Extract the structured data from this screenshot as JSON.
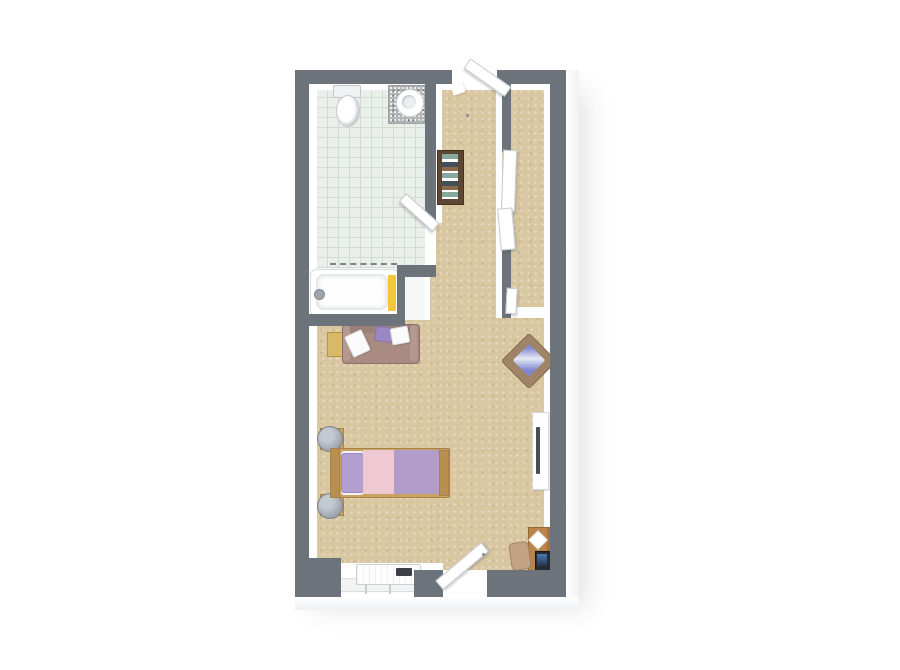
{
  "meta": {
    "type": "3d-floor-plan-top-view",
    "description": "Top-down 3D rendered floor plan of a studio suite: bathroom with tiled floor at top left, entry hall, right-side closet, and a combined living/sleeping room",
    "visible_text": ""
  },
  "colors": {
    "pageBg": "#ffffff",
    "wall": "#6c737b",
    "wallFace": "#ffffff",
    "carpet": "#d9c7a1",
    "tile": "#eaf0e9",
    "tileLine": "#cfdccf",
    "bathFloor": "#f6f7f7",
    "porcelain": "#eff1f3",
    "granite": "#b5b6b8",
    "towel": "#f2c73b",
    "curtain": "#5a5f63",
    "walnut": "#5f4632",
    "books1": "#86a89e",
    "books2": "#ffffff",
    "books3": "#43505a",
    "books4": "#8a6a4a",
    "sofa": "#a98b82",
    "sofaDark": "#8d7168",
    "sofaLight": "#b59890",
    "pillowWhite": "#fafafa",
    "pillowPurple": "#9d87c2",
    "tableWood": "#d8b96a",
    "wood": "#c9a25f",
    "woodDark": "#a8824a",
    "woodEdge": "#b78f4e",
    "pink": "#efc9d2",
    "lavender": "#b19cca",
    "bedPillow": "#b29fd0",
    "stool": "#9fa5ad",
    "stoolRing": "#7d838a",
    "chairWood": "#a08468",
    "cushionBlue": "#8087d2",
    "cushionLight": "#e6e9f5",
    "consoleWhite": "#fdfdfd",
    "tvDark": "#474c52",
    "oak": "#b9854a",
    "oakDark": "#96682f",
    "monitor": "#252b31",
    "screen": "#4a7ab5",
    "deskChair": "#c2a385",
    "ptac": "#fdfdfd",
    "vent": "#3c4147",
    "glass": "#f2f4f4",
    "mullion": "#c9ccce"
  },
  "rooms": {
    "bathroom": {
      "label": "Bathroom with tiled floor, toilet, vanity sink and bathtub"
    },
    "entry": {
      "label": "Entry hall with open door"
    },
    "closet": {
      "label": "Closet with sliding doors"
    },
    "living": {
      "label": "Living and sleeping area with carpet floor"
    }
  },
  "furniture": {
    "toilet": {
      "label": "Toilet"
    },
    "vanity": {
      "label": "Vanity counter with round sink"
    },
    "bathtub": {
      "label": "Bathtub with yellow towel"
    },
    "shower": {
      "label": "Wall-mounted shower head"
    },
    "curtain": {
      "label": "Shower curtain"
    },
    "bathroomDoor": {
      "label": "Bathroom door, open"
    },
    "entryDoor": {
      "label": "Entry door, open"
    },
    "bookshelf": {
      "label": "Dark wood bookshelf with books"
    },
    "sideTable": {
      "label": "Small wooden side table"
    },
    "sofa": {
      "label": "Loveseat sofa with white and purple pillows"
    },
    "bed": {
      "label": "Single bed with pink and lavender bedding"
    },
    "stools": {
      "label": "Round bedside stools on wooden bases"
    },
    "armchair": {
      "label": "Angled armchair with patterned cushion"
    },
    "tvConsole": {
      "label": "Wall console with TV"
    },
    "desk": {
      "label": "Wooden desk with monitor and paper"
    },
    "deskChair": {
      "label": "Desk chair"
    },
    "wardrobe": {
      "label": "Closet sliding door panels"
    },
    "ptac": {
      "label": "Heating / AC unit under window"
    },
    "window": {
      "label": "Window in bottom wall"
    },
    "patioDoor": {
      "label": "Second door in bottom wall, open"
    }
  }
}
